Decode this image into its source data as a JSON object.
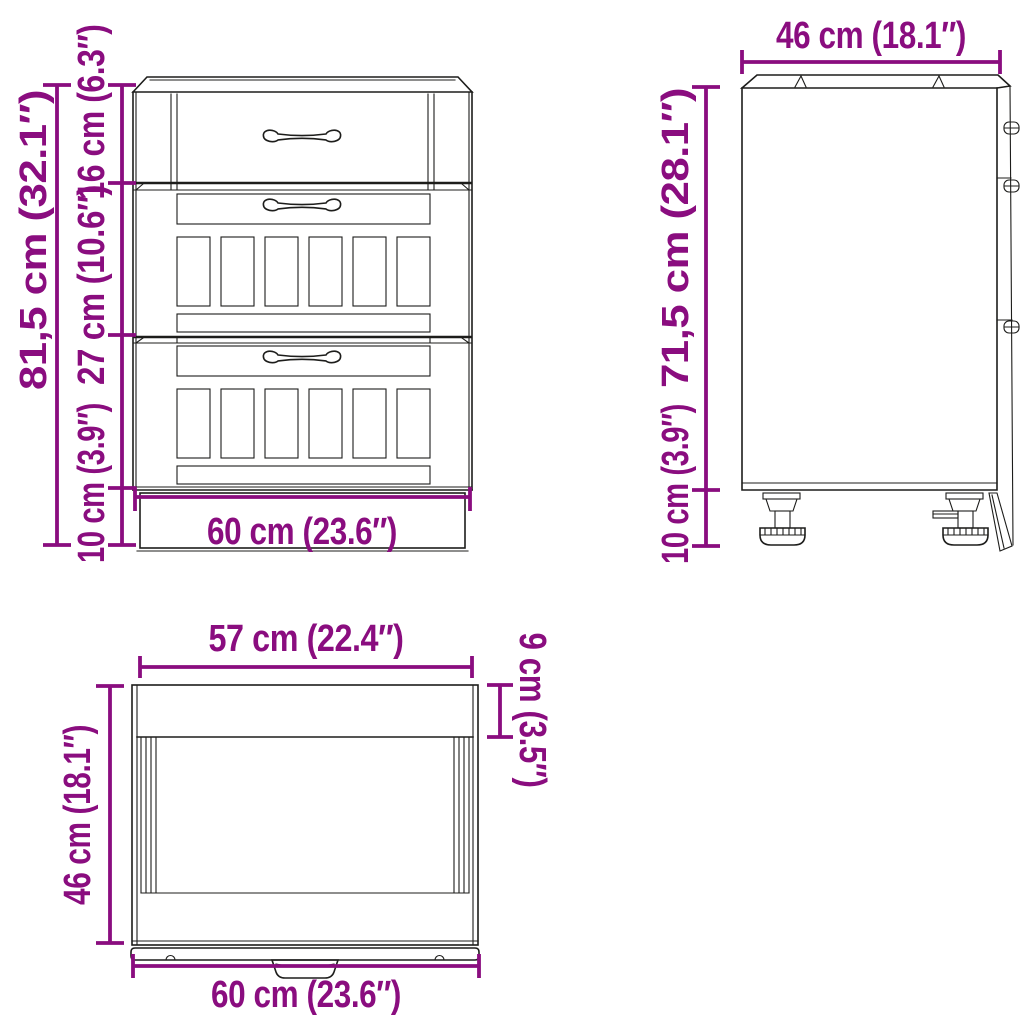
{
  "drawing": {
    "accent_color": "#8A0D7F",
    "line_color": "#1d1d1b",
    "background_color": "#ffffff",
    "front_view": {
      "labels": {
        "total_height": "81,5 cm (32.1″)",
        "top_drawer_height": "16 cm (6.3″)",
        "middle_drawer_height": "27 cm (10.6″)",
        "plinth_height": "10 cm (3.9″)",
        "width": "60 cm (23.6″)"
      }
    },
    "side_view": {
      "labels": {
        "depth": "46 cm (18.1″)",
        "body_height": "71,5 cm (28.1″)",
        "legs_height": "10 cm (3.9″)"
      }
    },
    "top_view": {
      "labels": {
        "inner_width": "57 cm (22.4″)",
        "depth": "46 cm (18.1″)",
        "outer_width": "60 cm (23.6″)",
        "back_band_depth": "9 cm (3.5″)"
      }
    }
  }
}
